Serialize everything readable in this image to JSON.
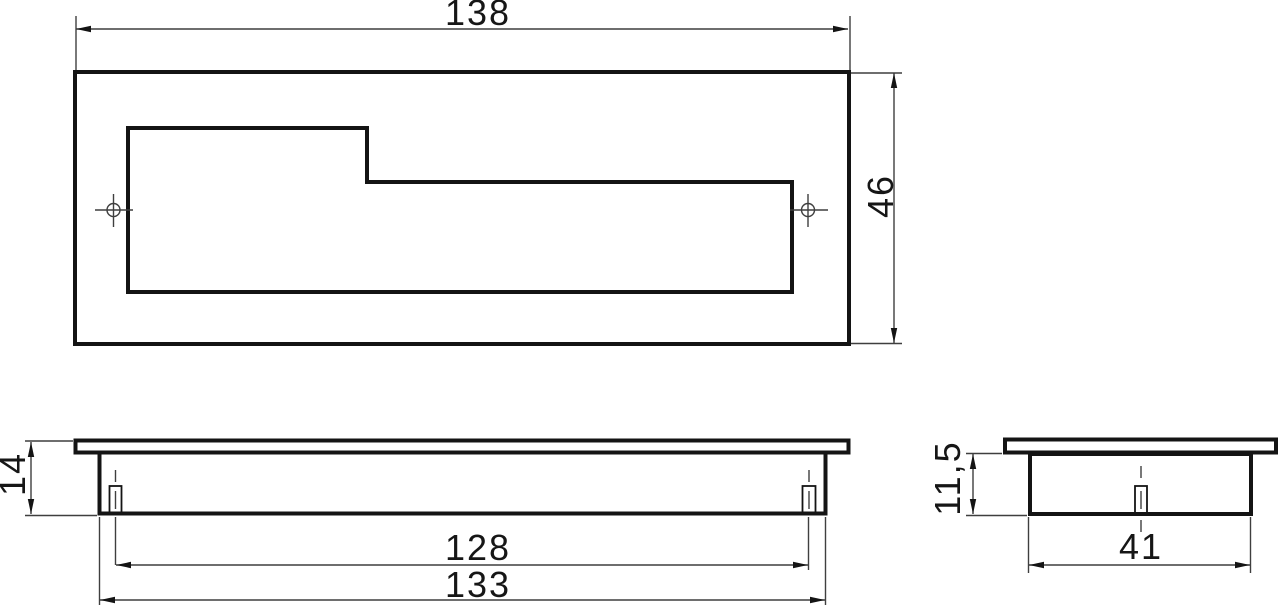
{
  "dimensions": {
    "top_width": "138",
    "top_height": "46",
    "front_height": "14",
    "hole_spacing": "128",
    "body_width": "133",
    "side_height": "11,5",
    "side_width": "41"
  },
  "colors": {
    "background": "#ffffff",
    "outline": "#141414",
    "dimension-line": "#3f3f3f",
    "text": "#161616"
  }
}
